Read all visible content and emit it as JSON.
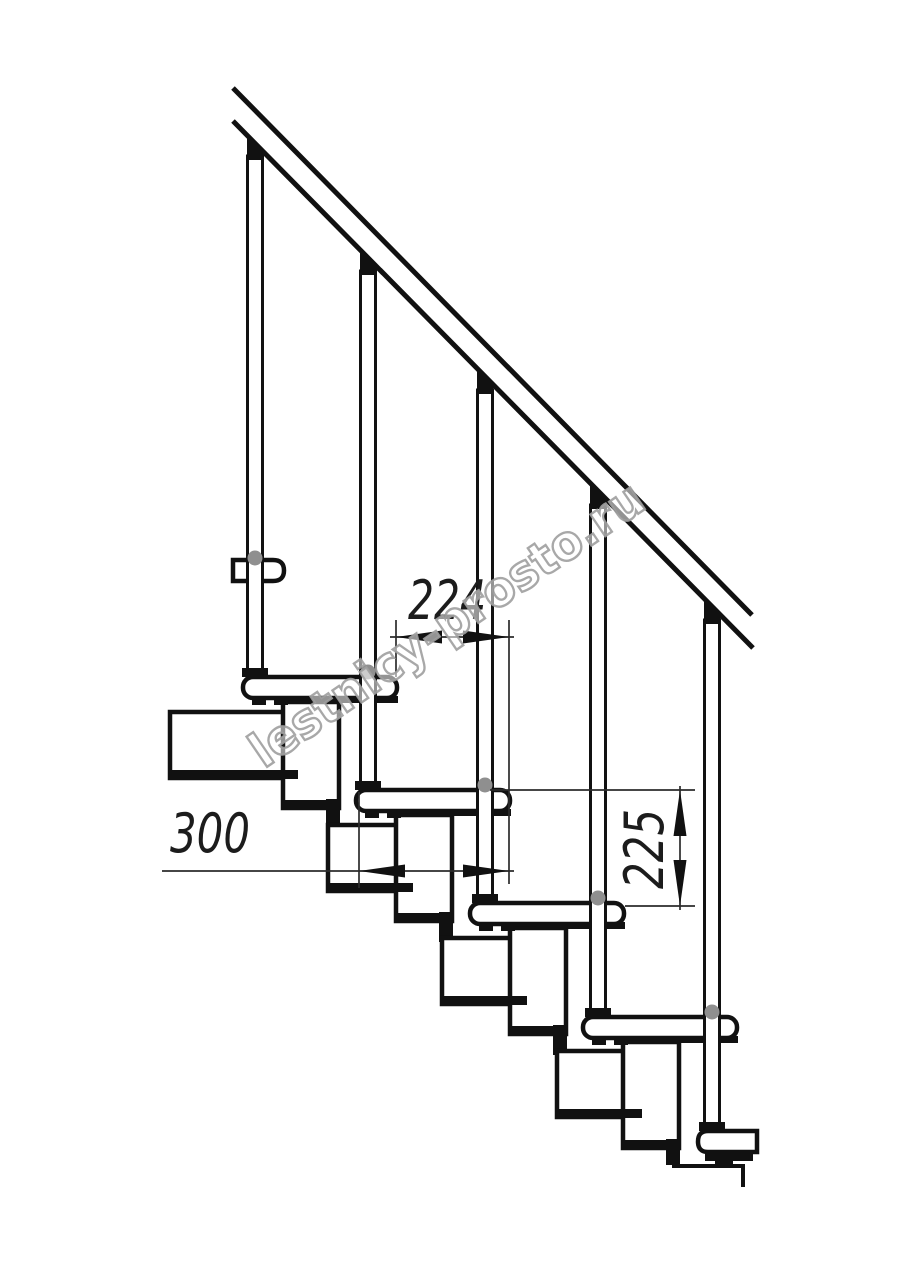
{
  "page": {
    "background": "#ffffff",
    "kind": "technical line drawing",
    "subject": "modular staircase side view with handrail, balusters, treads and support modules"
  },
  "dimensions": {
    "run": {
      "label": "224",
      "orientation": "horizontal"
    },
    "depth": {
      "label": "300",
      "orientation": "horizontal"
    },
    "rise": {
      "label": "225",
      "orientation": "vertical"
    }
  },
  "watermark": {
    "text": "lestnicy-prosto.ru",
    "outline_color": "#9e9e9e"
  },
  "drawing": {
    "line_color": "#111111",
    "dimension_line_color": "#2b2b2b",
    "bolt_color": "#8f8f8f",
    "balusters": 5,
    "full_treads": 5,
    "partial_treads": 2
  }
}
